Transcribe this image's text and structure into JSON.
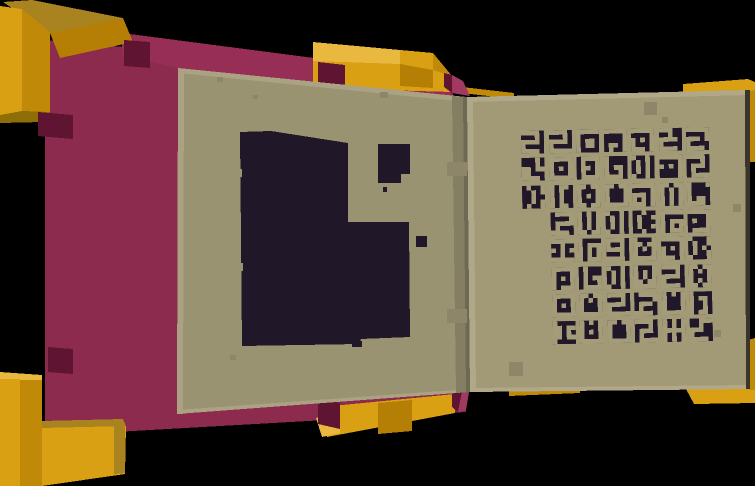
{
  "palette": {
    "bg": "#000000",
    "goldPale": "#e9b83f",
    "goldLight": "#d9a013",
    "goldMid": "#c08908",
    "goldMid2": "#b57f06",
    "goldOlive": "#a8831f",
    "goldDeep": "#8f6e07",
    "maroon": "#8d2b4f",
    "maroonTop": "#962e55",
    "maroonLight": "#a03a62",
    "maroonDark": "#5f1531",
    "pageL": "#9a9371",
    "pageLHi": "#aba283",
    "pageLLo": "#6e6952",
    "pageR": "#a29a77",
    "pageRHi": "#b0a888",
    "pageEdgeDark": "#3a352b",
    "gutter": "#847e63",
    "speckle": "#8d8669",
    "ink": "#201829"
  },
  "glyphs": {
    "ink": "#201829",
    "tan": "#a49c79",
    "library": {
      "s1": [
        "11110",
        "00010",
        "11110",
        "10000",
        "11110"
      ],
      "s1b": [
        "11110",
        "00010",
        "11110",
        "10000",
        "11111"
      ],
      "s1b2": [
        "01111",
        "00001",
        "01111",
        "01000",
        "11110"
      ],
      "s3": [
        "11100",
        "00100",
        "11110",
        "10000",
        "11110"
      ],
      "sd": [
        "11111",
        "00001",
        "11101",
        "10000",
        "11110"
      ],
      "zz": [
        "01111",
        "00001",
        "01110",
        "01000",
        "11110"
      ],
      "zz2": [
        "11110",
        "00010",
        "01110",
        "01000",
        "01111"
      ],
      "gam": [
        "11111",
        "10000",
        "10110",
        "10110",
        "10000"
      ],
      "nd": [
        "11111",
        "00001",
        "00001",
        "01101",
        "01001"
      ],
      "nd2": [
        "11111",
        "00001",
        "01001",
        "00001",
        "01111"
      ],
      "ndd": [
        "11111",
        "00001",
        "10101",
        "00001",
        "00001"
      ],
      "bxo": [
        "11111",
        "00001",
        "10101",
        "10001",
        "11101"
      ],
      "bxd": [
        "11111",
        "10001",
        "10101",
        "10001",
        "10111"
      ],
      "tri": [
        "00010",
        "00010",
        "11011",
        "11000",
        "11110"
      ],
      "ring": [
        "11111",
        "10001",
        "10101",
        "10001",
        "11111"
      ],
      "ring2": [
        "01111",
        "01001",
        "01101",
        "01001",
        "01111"
      ],
      "ringd": [
        "11011",
        "10001",
        "10101",
        "10001",
        "11011"
      ],
      "lb": [
        "10000",
        "10000",
        "10110",
        "10010",
        "11110"
      ],
      "lb2": [
        "01000",
        "01000",
        "01011",
        "01001",
        "01111"
      ],
      "pp": [
        "10010",
        "01010",
        "01010",
        "01010",
        "10010"
      ],
      "pd": [
        "01001",
        "00101",
        "00100",
        "00101",
        "01001"
      ],
      "pd2": [
        "10001",
        "01001",
        "01010",
        "01001",
        "10001"
      ],
      "pdd": [
        "00100",
        "01001",
        "01000",
        "01001",
        "00100"
      ],
      "brk": [
        "10110",
        "10100",
        "10100",
        "10100",
        "10110"
      ],
      "u2": [
        "11011",
        "10001",
        "10001",
        "10001",
        "11111"
      ],
      "u2d": [
        "10101",
        "10001",
        "10001",
        "10001",
        "11111"
      ],
      "uck": [
        "11011",
        "10101",
        "10001",
        "10001",
        "11111"
      ],
      "uck2": [
        "10101",
        "10001",
        "10101",
        "10001",
        "11111"
      ],
      "gs": [
        "11111",
        "00001",
        "11101",
        "10101",
        "11101"
      ],
      "gs2": [
        "11111",
        "10000",
        "10111",
        "10101",
        "10111"
      ],
      "gspi": [
        "11110",
        "10010",
        "11110",
        "00010",
        "11110"
      ],
      "wn": [
        "11011",
        "10101",
        "10101",
        "10101",
        "10101"
      ],
      "wn2": [
        "10101",
        "10101",
        "10101",
        "10101",
        "11011"
      ],
      "wn3": [
        "11011",
        "10101",
        "10001",
        "10101",
        "11011"
      ],
      "wu": [
        "10001",
        "11011",
        "10101",
        "10001",
        "11111"
      ],
      "wu2": [
        "10001",
        "10101",
        "10101",
        "11011",
        "11111"
      ],
      "tt": [
        "11111",
        "00100",
        "10101",
        "00100",
        "11111"
      ],
      "hh": [
        "10101",
        "10101",
        "11111",
        "10101",
        "10101"
      ],
      "cd": [
        "10000",
        "11011",
        "11010",
        "11011",
        "10000"
      ],
      "ld": [
        "10001",
        "10000",
        "10000",
        "10110",
        "11110"
      ],
      "lh": [
        "00111",
        "00100",
        "11100",
        "10000",
        "11110"
      ],
      "b6": [
        "10000",
        "10111",
        "10101",
        "10101",
        "10111"
      ],
      "b6b": [
        "10000",
        "10110",
        "10010",
        "10010",
        "10110"
      ]
    },
    "grid": [
      [
        "s1",
        "s1b",
        "gam",
        "nd",
        "bxo",
        "s3",
        "sd"
      ],
      [
        "tri",
        "ring",
        "ring2",
        "lb",
        "pp",
        "ndd",
        "zz2"
      ],
      [
        "pd",
        "brk",
        "ringd",
        "u2",
        "gs",
        "wn",
        "ld"
      ],
      [
        null,
        "s1b2",
        "wn2",
        "pp",
        "pdd",
        "gs2",
        "nd2"
      ],
      [
        null,
        "tt",
        "b6",
        "gspi",
        "wu",
        "bxo",
        "pd2"
      ],
      [
        null,
        "bxd",
        "lb2",
        "pp",
        "wu2",
        "s1",
        "wn3"
      ],
      [
        null,
        "ring",
        "uck",
        "s1b",
        "zz",
        "u2d",
        "b6b"
      ],
      [
        null,
        "cd",
        "uck2",
        "u2",
        "zz2",
        "hh",
        "lh"
      ]
    ]
  }
}
